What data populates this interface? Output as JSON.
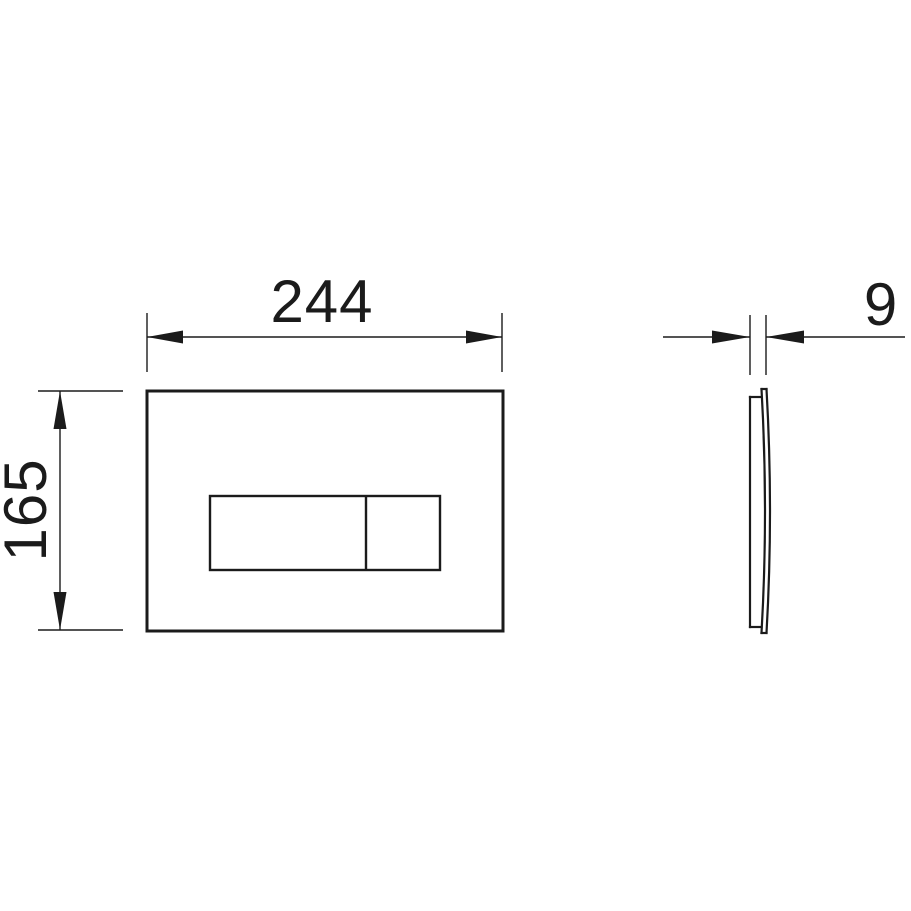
{
  "dimensions": {
    "width": {
      "label": "244"
    },
    "height": {
      "label": "165"
    },
    "thickness": {
      "label": "9"
    }
  },
  "colors": {
    "line": "#1b1b1b",
    "background": "#ffffff"
  }
}
